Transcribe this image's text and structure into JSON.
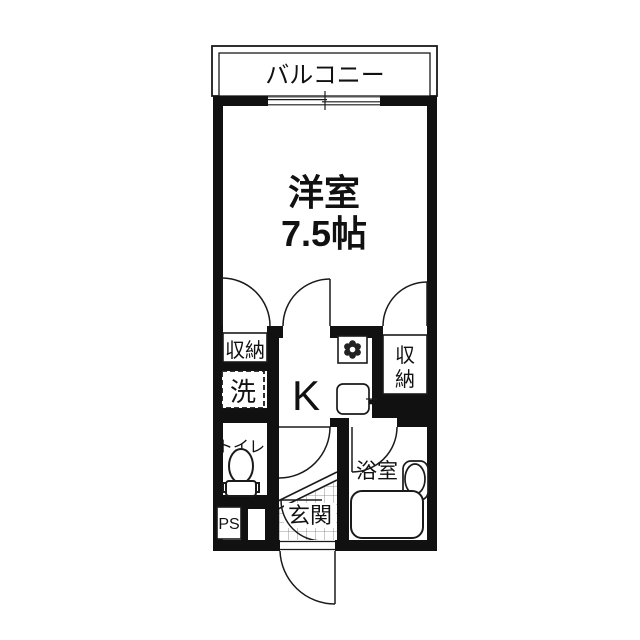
{
  "labels": {
    "balcony": "バルコニー",
    "main_room_name": "洋室",
    "main_room_size": "7.5帖",
    "kitchen": "K",
    "closet_left": "収納",
    "closet_right_char1": "収",
    "closet_right_char2": "納",
    "washer": "洗",
    "toilet": "トイレ",
    "pipe_space": "PS",
    "entrance": "玄関",
    "bath": "浴室"
  },
  "colors": {
    "wall": "#111111",
    "line": "#1a1a1a",
    "background": "#ffffff",
    "grid_line": "#777777"
  }
}
